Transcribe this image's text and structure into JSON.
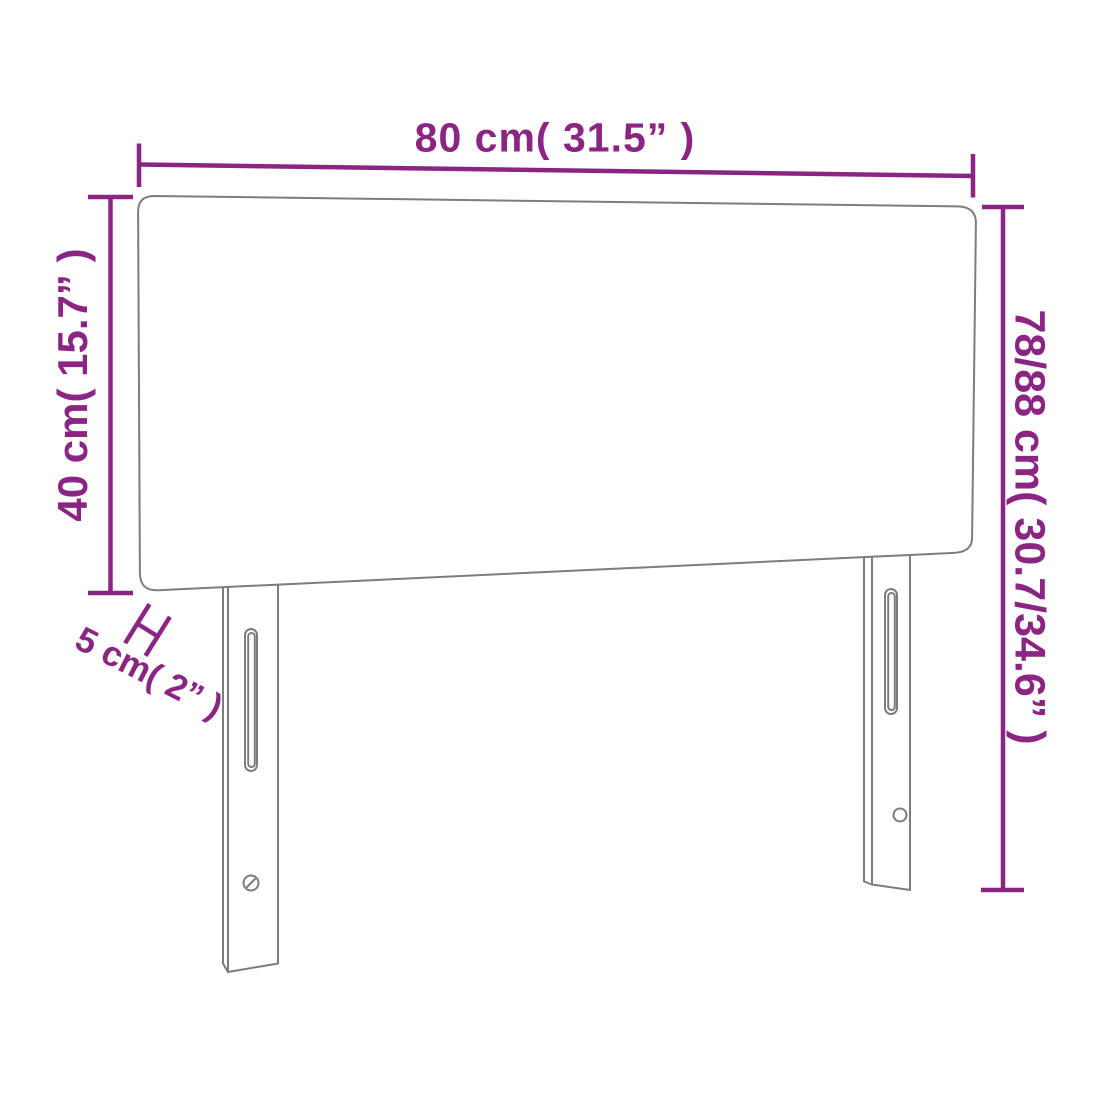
{
  "diagram": {
    "kind": "furniture-dimension-diagram",
    "subject": "headboard with two legs"
  },
  "dimensions": {
    "width": "80 cm( 31.5” )",
    "panel_height": "40 cm( 15.7” )",
    "thickness": "5 cm( 2” )",
    "total_height": "78/88 cm( 30.7/34.6” )"
  },
  "colors": {
    "dimension": "#8B2584",
    "outline": "#7d7d7d",
    "background": "#ffffff"
  }
}
